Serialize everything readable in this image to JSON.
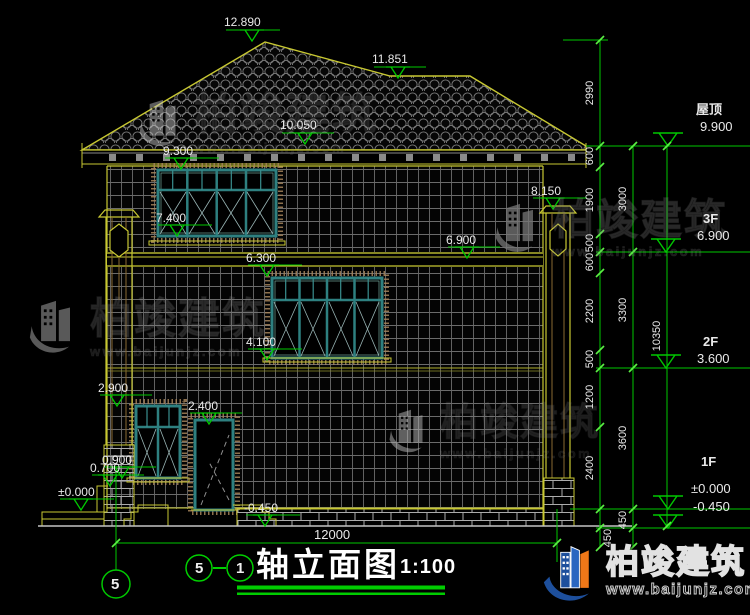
{
  "drawing": {
    "title": {
      "axis_from": "5",
      "axis_to": "1",
      "name": "轴立面图",
      "scale": "1:100"
    },
    "axis_bubble": "5"
  },
  "elevations": {
    "ridge": "12.890",
    "ridge2": "11.851",
    "roof_slope": "10.050",
    "f3_window_top": "9.300",
    "f3_window_sill": "7.400",
    "pillar_cap": "8.150",
    "f3_floor": "6.900",
    "f2_window_top": "6.300",
    "f2_window_sill": "4.100",
    "f1_window_top": "2.900",
    "door_top": "2.400",
    "f1_window_sill": "0.900",
    "porch_rail": "0.700",
    "f1_floor": "±0.000",
    "ground": "-0.450"
  },
  "story_levels": [
    {
      "name": "屋顶",
      "elev": "9.900"
    },
    {
      "name": "3F",
      "elev": "6.900"
    },
    {
      "name": "2F",
      "elev": "3.600"
    },
    {
      "name": "1F",
      "elev": "±0.000"
    },
    {
      "name": "",
      "elev": "-0.450"
    }
  ],
  "dimensions": {
    "inner": [
      "2990",
      "600",
      "1900",
      "500",
      "600",
      "2200",
      "500",
      "1200",
      "2400",
      "450"
    ],
    "middle": [
      "3000",
      "3300",
      "3600",
      "450"
    ],
    "overall_height": "10350",
    "overall_width": "12000"
  },
  "brand": {
    "name": "柏竣建筑",
    "url": "www.baijunjz.com"
  },
  "colors": {
    "dim_green": "#00c800",
    "outline_yellow": "#c8c832",
    "window_teal": "#2e8080",
    "logo_blue": "#1d4f9c",
    "logo_orange": "#f07818"
  }
}
